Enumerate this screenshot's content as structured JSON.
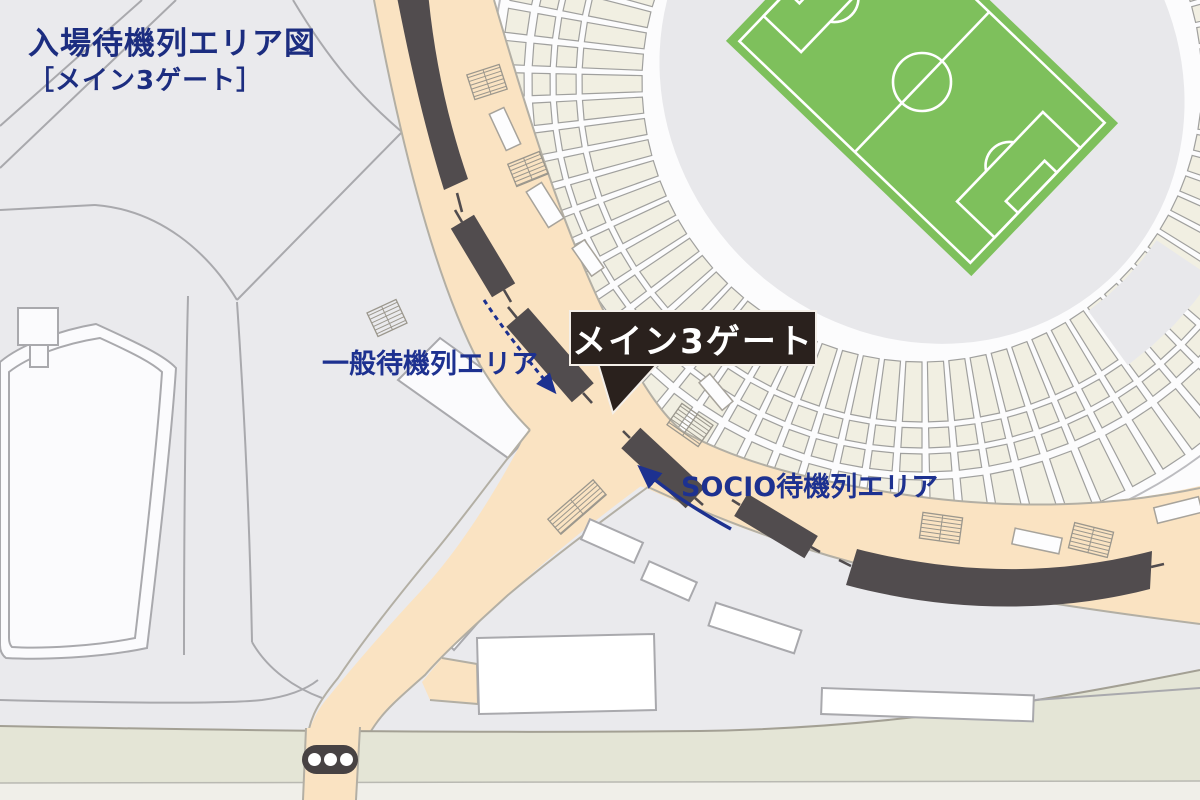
{
  "header": {
    "title": "入場待機列エリア図",
    "subtitle": "［メイン3ゲート］"
  },
  "map": {
    "gate_callout": "メイン3ゲート",
    "general_queue_label": "一般待機列エリア",
    "socio_queue_label": "SOCIO待機列エリア",
    "icons": {
      "traffic_light": "traffic-light-icon",
      "gate_pointer": "callout-pointer",
      "general_arrow": "dashed-route-arrow",
      "socio_arrow": "solid-route-arrow"
    },
    "colors": {
      "background": "#eaeaed",
      "navy_text": "#1c2d80",
      "concourse_beige": "#fae3c2",
      "queue_block_dark": "#514c4e",
      "pitch_green": "#7ec05c",
      "seat_cream": "#f1efe2",
      "callout_bg": "#2a211d",
      "road_green": "#e4e5d6",
      "road_light": "#f0efe9",
      "building_white": "#fbfbfd"
    }
  }
}
